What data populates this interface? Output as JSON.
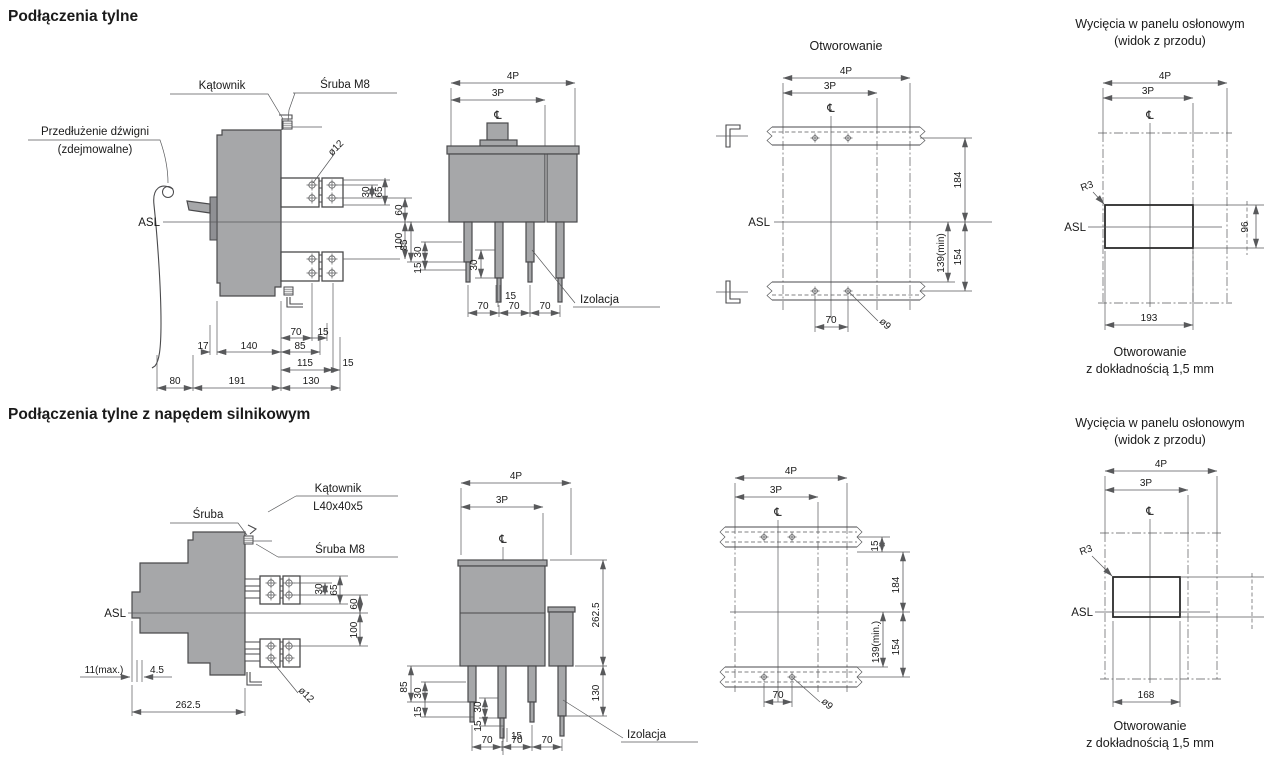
{
  "colors": {
    "bg": "#ffffff",
    "body": "#a6a7a9",
    "body_dark": "#8f9094",
    "outline": "#4a4a4c",
    "dim": "#58595b",
    "text": "#1a1a1a"
  },
  "headings": {
    "row1": "Podłączenia tylne",
    "row2": "Podłączenia tylne z napędem silnikowym"
  },
  "r1side": {
    "labels": {
      "katownik": "Kątownik",
      "srubaM8": "Śruba M8",
      "lever1": "Przedłużenie dźwigni",
      "lever2": "(zdejmowalne)",
      "asl": "ASL",
      "dia12": "ø12"
    },
    "dims": {
      "d30": "30",
      "d65": "65",
      "d60": "60",
      "d100": "100",
      "d70": "70",
      "d15a": "15",
      "d17": "17",
      "d140": "140",
      "d85": "85",
      "d115": "115",
      "d15b": "15",
      "d80": "80",
      "d191": "191",
      "d130": "130"
    }
  },
  "r1front": {
    "labels": {
      "p4": "4P",
      "p3": "3P",
      "cl": "℄",
      "izolacja": "Izolacja"
    },
    "dims": {
      "d85": "85",
      "d30a": "30",
      "d15a": "15",
      "d30b": "30",
      "d15b": "15",
      "d70a": "70",
      "d70b": "70",
      "d70c": "70"
    }
  },
  "r1drill": {
    "labels": {
      "title": "Otworowanie",
      "p4": "4P",
      "p3": "3P",
      "cl": "℄",
      "asl": "ASL"
    },
    "dims": {
      "d184": "184",
      "d154": "154",
      "d139": "139(min)",
      "d70": "70",
      "dia9": "ø9"
    }
  },
  "r1cut": {
    "labels": {
      "title1": "Wycięcia w panelu osłonowym",
      "title2": "(widok z przodu)",
      "p4": "4P",
      "p3": "3P",
      "cl": "℄",
      "asl": "ASL",
      "r3": "R3",
      "cap1": "Otworowanie",
      "cap2": "z dokładnością 1,5 mm"
    },
    "dims": {
      "d193": "193",
      "dh": "96"
    }
  },
  "r2side": {
    "labels": {
      "sruba": "Śruba",
      "kat1": "Kątownik",
      "kat2": "L40x40x5",
      "srubaM8": "Śruba M8",
      "asl": "ASL",
      "dia12": "ø12"
    },
    "dims": {
      "d30": "30",
      "d65": "65",
      "d60": "60",
      "d100": "100",
      "d11": "11(max.)",
      "d45": "4.5",
      "d2625": "262.5"
    }
  },
  "r2front": {
    "labels": {
      "p4": "4P",
      "p3": "3P",
      "cl": "℄",
      "izolacja": "Izolacja"
    },
    "dims": {
      "d2625": "262.5",
      "d130": "130",
      "d85": "85",
      "d30a": "30",
      "d15a": "15",
      "d30b": "30",
      "d15b": "15",
      "d15c": "15",
      "d70a": "70",
      "d70b": "70",
      "d70c": "70"
    }
  },
  "r2drill": {
    "labels": {
      "p4": "4P",
      "p3": "3P",
      "cl": "℄"
    },
    "dims": {
      "d15": "15",
      "d184": "184",
      "d154": "154",
      "d139": "139(min.)",
      "d70": "70",
      "dia9": "ø9"
    }
  },
  "r2cut": {
    "labels": {
      "title1": "Wycięcia w panelu osłonowym",
      "title2": "(widok z przodu)",
      "p4": "4P",
      "p3": "3P",
      "cl": "℄",
      "asl": "ASL",
      "r3": "R3",
      "cap1": "Otworowanie",
      "cap2": "z dokładnością 1,5 mm"
    },
    "dims": {
      "d168": "168"
    }
  }
}
